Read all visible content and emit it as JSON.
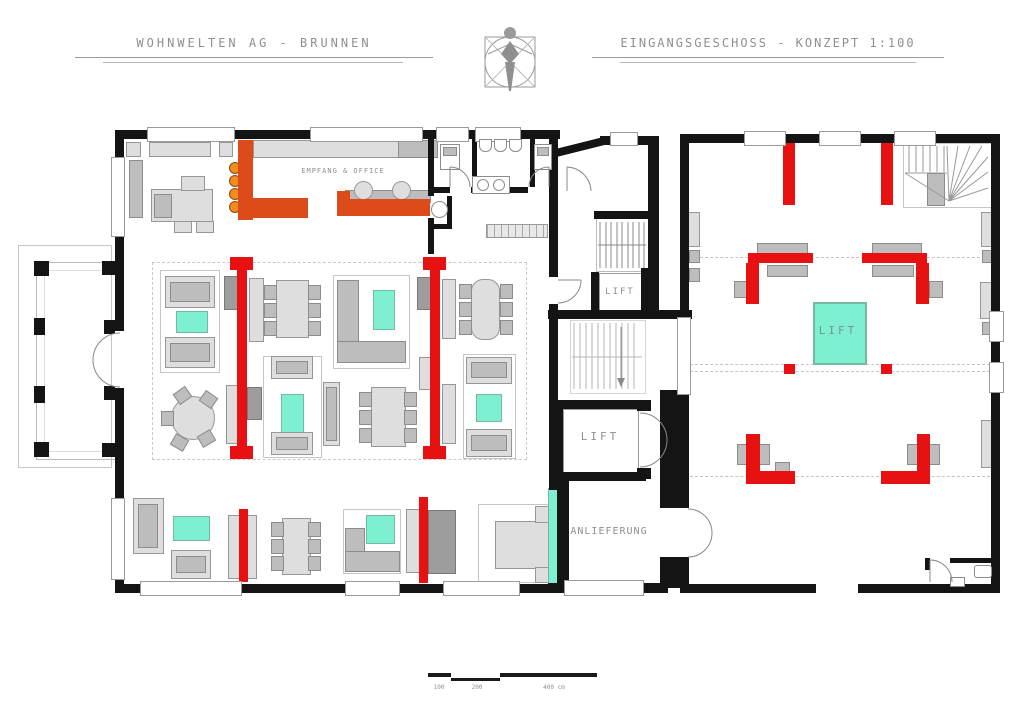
{
  "header": {
    "project_title": "WOHNWELTEN AG - BRUNNEN",
    "sheet_title": "EINGANGSGESCHOSS - KONZEPT 1:100",
    "logo_icon": "vitruvian-man"
  },
  "rooms": {
    "reception_label": "EMPFANG & OFFICE",
    "stair_core_lift_label": "LIFT",
    "delivery_lift_label": "LIFT",
    "showroom_lift_label": "LIFT",
    "delivery_label": "ANLIEFERUNG"
  },
  "scale_bar": {
    "labels": [
      "100",
      "200",
      "400 cm"
    ]
  },
  "legend_colors": {
    "wall_black": "#141414",
    "accent_red": "#e81111",
    "counter_orange": "#dd4b1a",
    "stool_orange": "#ef8d1f",
    "table_aqua": "#7df0d2",
    "furniture_light_gray": "#dedede",
    "furniture_mid_gray": "#bdbdbd"
  }
}
